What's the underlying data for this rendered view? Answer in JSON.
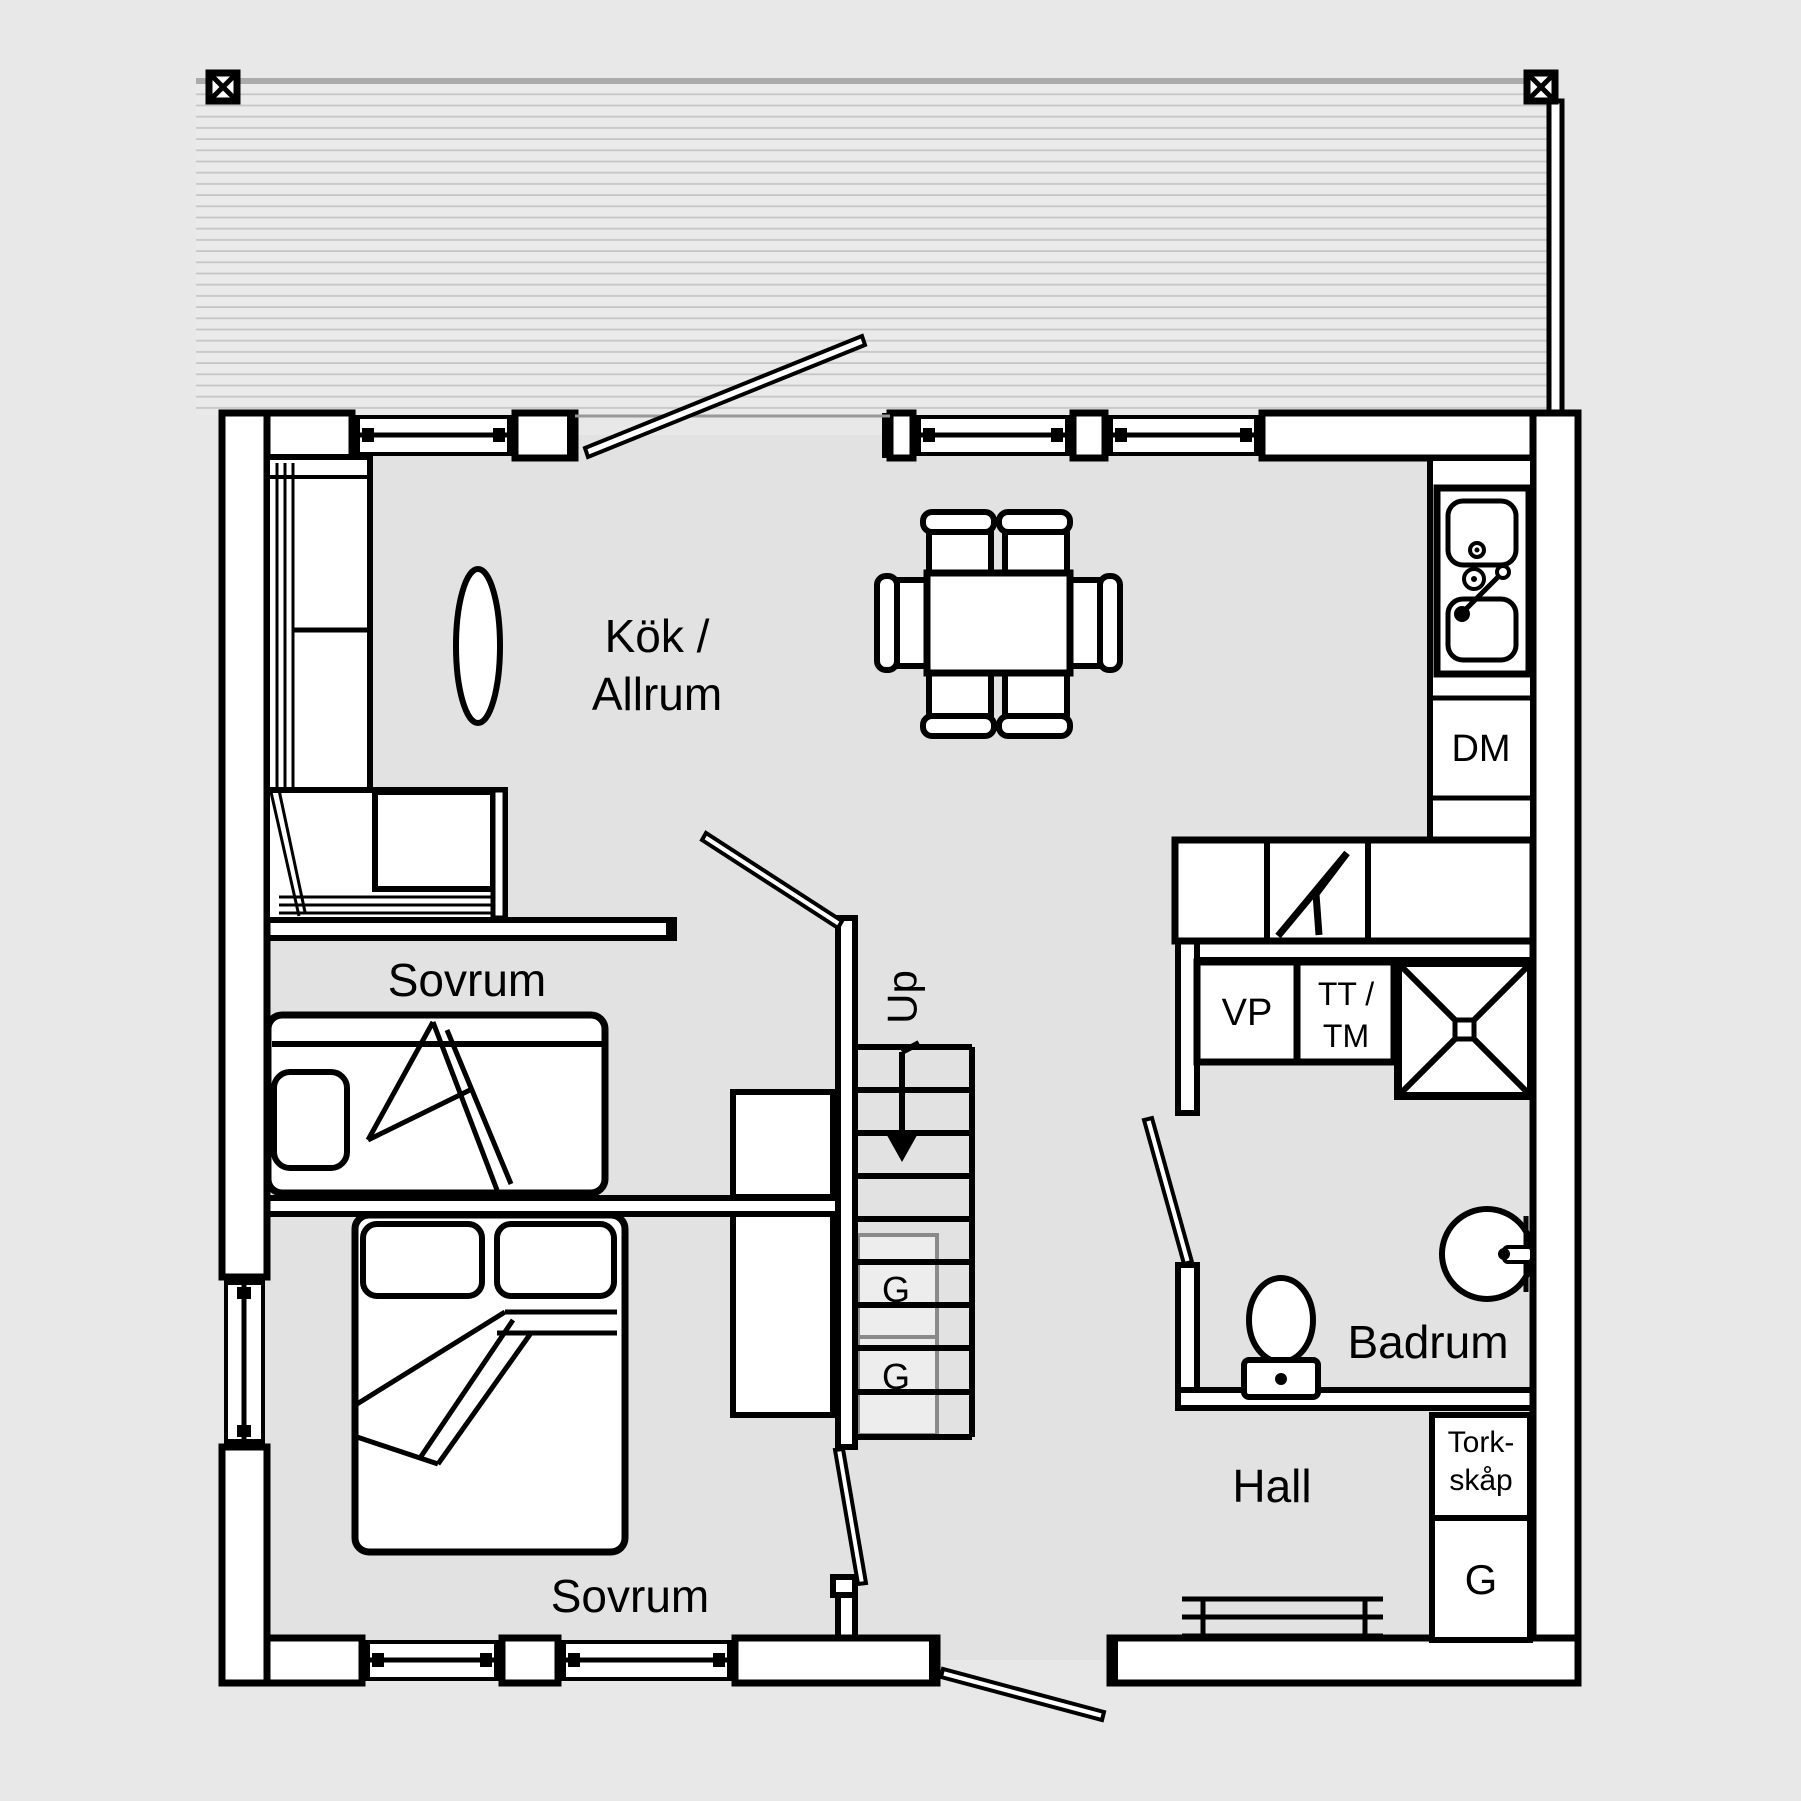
{
  "rooms": {
    "kitchen_living": {
      "line1": "Kök /",
      "line2": "Allrum"
    },
    "bedroom1": {
      "label": "Sovrum"
    },
    "bedroom2": {
      "label": "Sovrum"
    },
    "bathroom": {
      "label": "Badrum"
    },
    "hall": {
      "label": "Hall"
    }
  },
  "stairs": {
    "up_label": "Up",
    "closet1_label": "G",
    "closet2_label": "G"
  },
  "appliances": {
    "dishwasher": "DM",
    "heat_pump": "VP",
    "dryer_washer_line1": "TT /",
    "dryer_washer_line2": "TM",
    "drying_cabinet_line1": "Tork-",
    "drying_cabinet_line2": "skåp",
    "wardrobe": "G"
  },
  "colors": {
    "outside": "#e8e8e8",
    "floor": "#e2e2e2",
    "deck": "#eaeaea",
    "deck_hatch": "#c6c6c6",
    "wall_line": "#000000",
    "understair_gray": "#8a8a8a",
    "fixture_fill": "#ffffff"
  }
}
